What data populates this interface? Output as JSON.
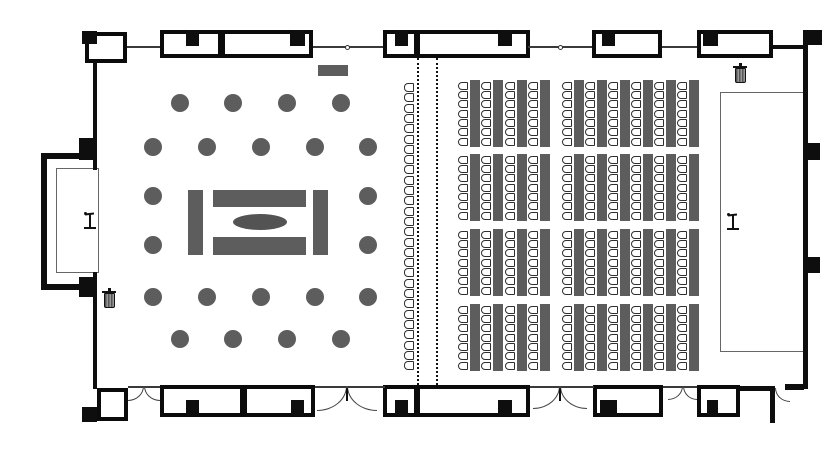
{
  "meta": {
    "type": "banquet-event-hall-floor-plan",
    "description": "Floor plan: round banquet tables with central buffet on left, classroom seating rows on right, movable partition in middle"
  },
  "canvas": {
    "width": 840,
    "height": 450,
    "bg": "#ffffff"
  },
  "palette": {
    "wall": "#0e0e0e",
    "thin_line": "#3a3a3a",
    "furniture": "#5d5d5d",
    "chair_border": "#2e2e2e",
    "partition": "#111111"
  },
  "walls": {
    "black_rects": [
      [
        82,
        31,
        15,
        13
      ],
      [
        803,
        30,
        19,
        15
      ],
      [
        803,
        143,
        17,
        17
      ],
      [
        803,
        257,
        17,
        16
      ],
      [
        79,
        138,
        18,
        22
      ],
      [
        79,
        277,
        18,
        20
      ],
      [
        82,
        407,
        15,
        15
      ],
      [
        186,
        30,
        13,
        16
      ],
      [
        290,
        30,
        15,
        16
      ],
      [
        395,
        30,
        13,
        16
      ],
      [
        498,
        30,
        14,
        16
      ],
      [
        602,
        30,
        13,
        16
      ],
      [
        703,
        30,
        15,
        16
      ],
      [
        186,
        400,
        13,
        16
      ],
      [
        291,
        400,
        13,
        16
      ],
      [
        395,
        400,
        13,
        16
      ],
      [
        498,
        400,
        14,
        16
      ],
      [
        600,
        400,
        17,
        16
      ],
      [
        707,
        400,
        11,
        16
      ],
      [
        41,
        153,
        6,
        137
      ],
      [
        41,
        153,
        56,
        6
      ],
      [
        41,
        284,
        56,
        6
      ],
      [
        93,
        61,
        4,
        109
      ],
      [
        93,
        272,
        4,
        117
      ],
      [
        803,
        44,
        5,
        345
      ],
      [
        773,
        45,
        34,
        4
      ],
      [
        740,
        386,
        31,
        5
      ],
      [
        770,
        386,
        5,
        37
      ],
      [
        785,
        384,
        19,
        6
      ]
    ],
    "bays": [
      [
        160,
        30,
        62,
        28
      ],
      [
        221,
        30,
        92,
        28
      ],
      [
        383,
        30,
        35,
        28
      ],
      [
        416,
        30,
        114,
        28
      ],
      [
        592,
        30,
        70,
        28
      ],
      [
        697,
        30,
        76,
        28
      ],
      [
        160,
        385,
        84,
        32
      ],
      [
        243,
        385,
        72,
        32
      ],
      [
        383,
        385,
        35,
        32
      ],
      [
        416,
        385,
        114,
        32
      ],
      [
        593,
        385,
        70,
        32
      ],
      [
        697,
        385,
        43,
        32
      ]
    ],
    "corner_rooms": [
      [
        85,
        32,
        42,
        31
      ],
      [
        97,
        388,
        31,
        33
      ]
    ],
    "outline_rects": [
      [
        56,
        168,
        43,
        105
      ],
      [
        720,
        92,
        85,
        260
      ]
    ],
    "thin_lines": [
      [
        127,
        46,
        33,
        2
      ],
      [
        313,
        46,
        70,
        2
      ],
      [
        528,
        46,
        64,
        2
      ],
      [
        662,
        46,
        35,
        2
      ],
      [
        128,
        386,
        32,
        2
      ],
      [
        315,
        386,
        70,
        2
      ],
      [
        530,
        386,
        64,
        2
      ],
      [
        663,
        386,
        34,
        2
      ]
    ],
    "joints": [
      [
        347,
        47
      ],
      [
        560,
        47
      ]
    ]
  },
  "doors": {
    "arcs": [
      {
        "x": 128,
        "y": 386,
        "w": 16,
        "h": 15,
        "t": "br"
      },
      {
        "x": 144,
        "y": 386,
        "w": 16,
        "h": 15,
        "t": "bl"
      },
      {
        "x": 317,
        "y": 386,
        "w": 30,
        "h": 25,
        "t": "br"
      },
      {
        "x": 347,
        "y": 386,
        "w": 30,
        "h": 25,
        "t": "bl"
      },
      {
        "x": 533,
        "y": 386,
        "w": 27,
        "h": 23,
        "t": "br"
      },
      {
        "x": 560,
        "y": 386,
        "w": 27,
        "h": 23,
        "t": "bl"
      },
      {
        "x": 668,
        "y": 386,
        "w": 15,
        "h": 14,
        "t": "br"
      },
      {
        "x": 683,
        "y": 386,
        "w": 14,
        "h": 14,
        "t": "bl"
      },
      {
        "x": 775,
        "y": 388,
        "w": 15,
        "h": 14,
        "t": "bl"
      }
    ],
    "posts": [
      [
        346,
        388,
        2,
        13
      ],
      [
        559,
        388,
        2,
        13
      ]
    ]
  },
  "partition": {
    "xs": [
      417,
      436
    ],
    "y": 58,
    "height": 327
  },
  "furniture": {
    "round_tables": {
      "diameter": 18,
      "rows": [
        {
          "y": 103,
          "xs": [
            180,
            233,
            287,
            341
          ]
        },
        {
          "y": 147,
          "xs": [
            153,
            207,
            261,
            315,
            368
          ]
        },
        {
          "y": 196,
          "xs": [
            153,
            368
          ]
        },
        {
          "y": 245,
          "xs": [
            153,
            368
          ]
        },
        {
          "y": 297,
          "xs": [
            153,
            207,
            261,
            315,
            368
          ]
        },
        {
          "y": 339,
          "xs": [
            180,
            233,
            287,
            341
          ]
        }
      ]
    },
    "buffet": {
      "rects": [
        [
          188,
          190,
          15,
          65
        ],
        [
          313,
          190,
          15,
          65
        ],
        [
          213,
          190,
          93,
          17
        ],
        [
          213,
          237,
          93,
          18
        ]
      ],
      "ellipse": {
        "cx": 260,
        "cy": 222,
        "rx": 27,
        "ry": 8
      }
    },
    "side_table": [
      318,
      65,
      30,
      11
    ],
    "classroom": {
      "row_ys": [
        80,
        154,
        229,
        304
      ],
      "table_height": 67,
      "chairs_per_column": 7,
      "chair": {
        "w": 10,
        "h": 8,
        "pitch": 9.35,
        "top_offset": 1.5
      },
      "table": {
        "dx": 11.5,
        "w": 10
      },
      "groups": [
        {
          "chair_xs": [
            458,
            481,
            505,
            528
          ]
        },
        {
          "chair_xs": [
            562,
            585,
            608,
            631,
            654,
            677
          ]
        }
      ]
    },
    "theater_row": {
      "x": 404,
      "y": 83,
      "count": 28,
      "pitch": 10.3,
      "chair": {
        "w": 10,
        "h": 9
      }
    }
  },
  "icons": {
    "trash_bins": [
      [
        102,
        288
      ],
      [
        733,
        63
      ]
    ],
    "stands": [
      [
        83,
        211
      ],
      [
        726,
        212
      ]
    ]
  }
}
